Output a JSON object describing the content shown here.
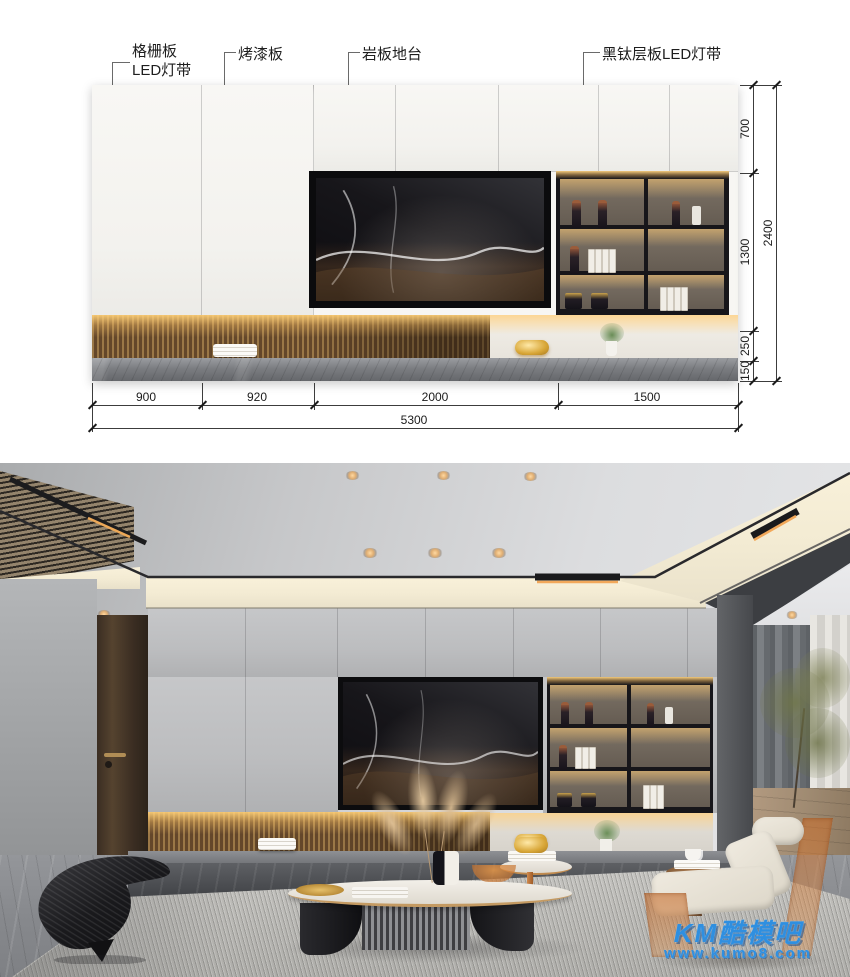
{
  "elevation": {
    "annotations": {
      "grille": {
        "line1": "格栅板",
        "line2": "LED灯带"
      },
      "lacquer": "烤漆板",
      "slab": "岩板地台",
      "shelf": "黑钛层板LED灯带"
    },
    "dims": {
      "v": [
        "700",
        "1300",
        "250",
        "150"
      ],
      "v_total": "2400",
      "h": [
        "900",
        "920",
        "2000",
        "1500"
      ],
      "h_total": "5300"
    }
  },
  "watermark": {
    "brand": "KM酷模吧",
    "url": "www.kumo8.com"
  },
  "colors": {
    "led_glow": "#f5c778",
    "wood_slat": "#8a6a42",
    "titanium_black": "#17161a",
    "stone_gray": "#84868a",
    "watermark_blue": "#2f8fe0"
  }
}
